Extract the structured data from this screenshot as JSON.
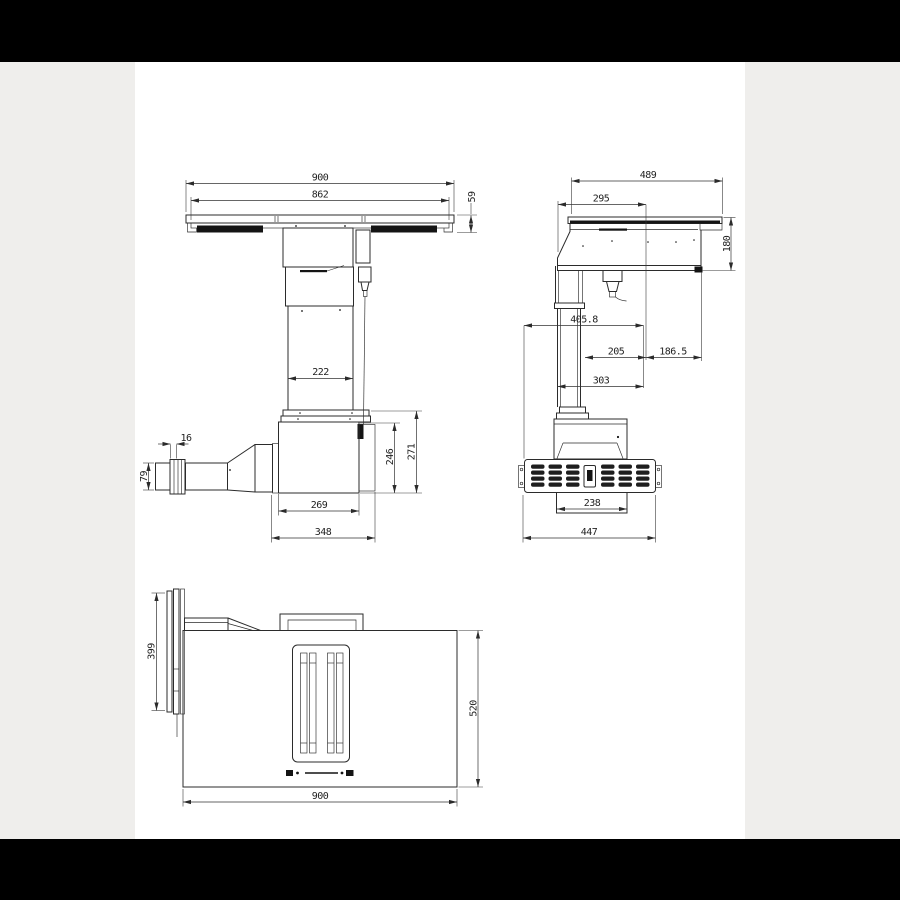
{
  "colors": {
    "background": "#efeeec",
    "panel": "#ffffff",
    "letterbox": "#000000",
    "line": "#2b2b2b",
    "dimension_text": "#1f1f1f"
  },
  "drawing": {
    "front_view": {
      "dims": {
        "overall_width": "900",
        "glass_width": "862",
        "top_edge_height": "59",
        "column_width": "222",
        "flange_thickness": "16",
        "outlet_height": "79",
        "motor_box_height": "246",
        "motor_assembly_height": "271",
        "motor_box_width": "269",
        "motor_assembly_width": "348"
      }
    },
    "side_view": {
      "dims": {
        "overall_depth": "489",
        "top_front_depth": "295",
        "body_height": "180",
        "grille_to_front": "405.8",
        "column_to_front": "205",
        "front_overhang": "186.5",
        "column_back_to_front": "303",
        "outlet_box_depth": "238",
        "grille_depth": "447"
      }
    },
    "plan_view": {
      "dims": {
        "flange_width": "399",
        "body_depth": "520",
        "overall_width": "900"
      }
    }
  }
}
